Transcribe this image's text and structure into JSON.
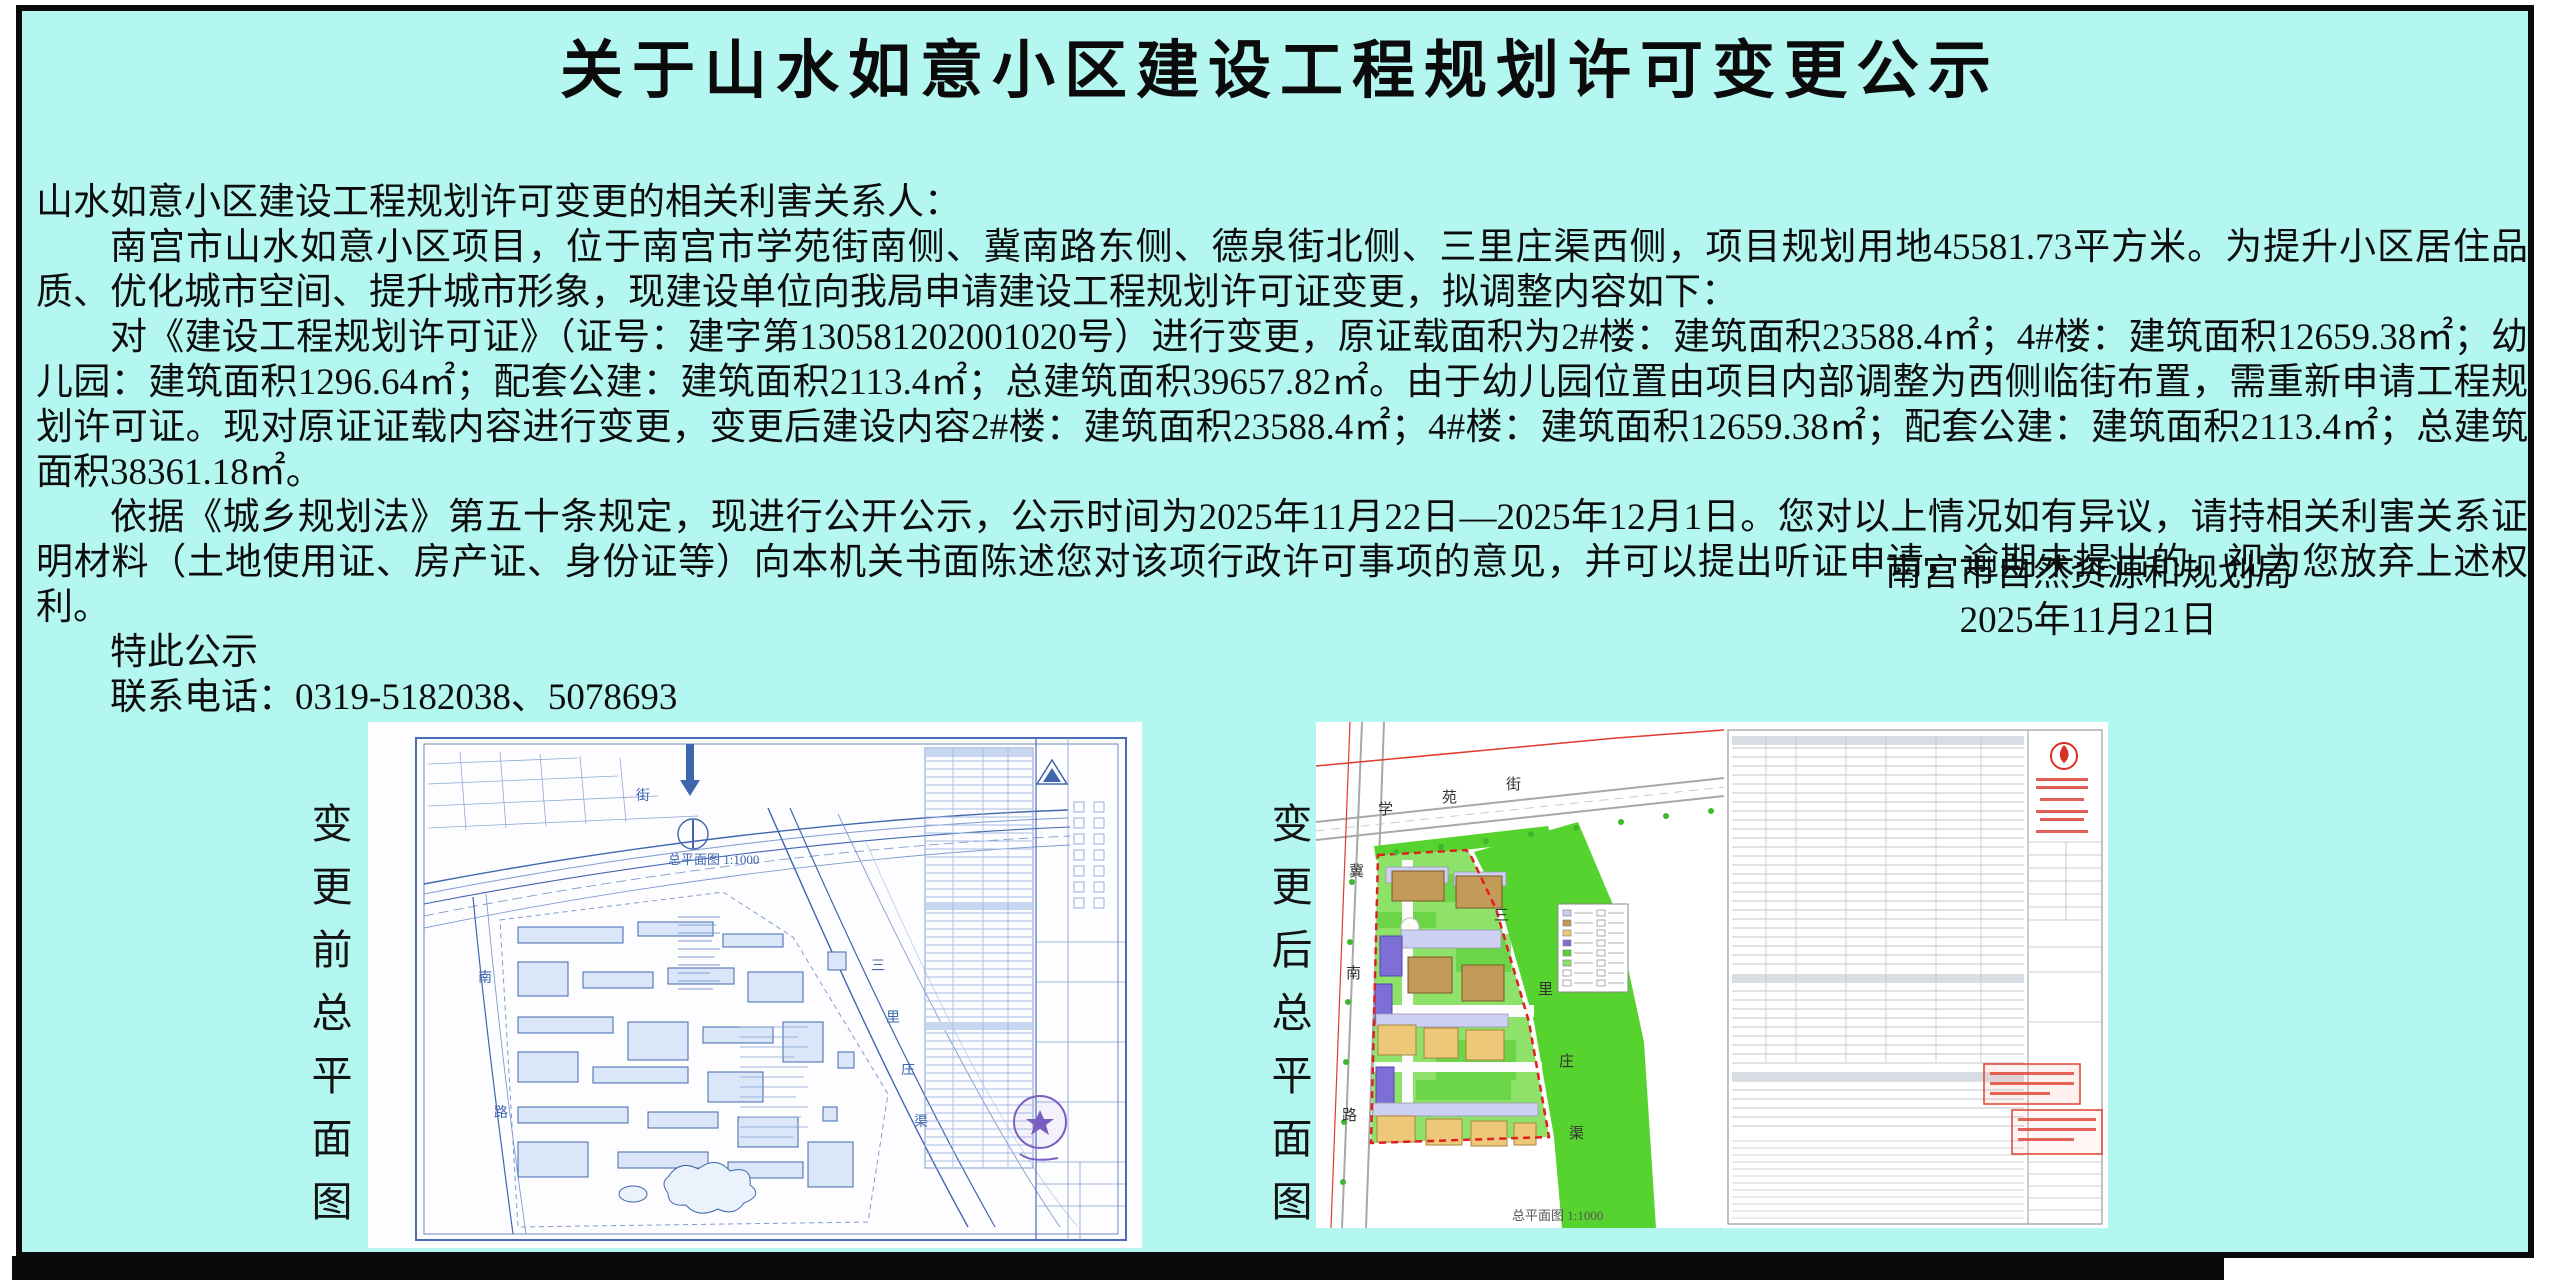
{
  "page": {
    "background_color": "#b4f6f0",
    "frame_color": "#0a0a0a"
  },
  "notice": {
    "title": "关于山水如意小区建设工程规划许可变更公示",
    "salutation": "山水如意小区建设工程规划许可变更的相关利害关系人：",
    "para1": "南宫市山水如意小区项目，位于南宫市学苑街南侧、冀南路东侧、德泉街北侧、三里庄渠西侧，项目规划用地45581.73平方米。为提升小区居住品质、优化城市空间、提升城市形象，现建设单位向我局申请建设工程规划许可证变更，拟调整内容如下：",
    "para2": "对《建设工程规划许可证》（证号：建字第130581202001020号）进行变更，原证载面积为2#楼：建筑面积23588.4㎡；4#楼：建筑面积12659.38㎡；幼儿园：建筑面积1296.64㎡；配套公建：建筑面积2113.4㎡；总建筑面积39657.82㎡。由于幼儿园位置由项目内部调整为西侧临街布置，需重新申请工程规划许可证。现对原证证载内容进行变更，变更后建设内容2#楼：建筑面积23588.4㎡；4#楼：建筑面积12659.38㎡；配套公建：建筑面积2113.4㎡；总建筑面积38361.18㎡。",
    "para3": "依据《城乡规划法》第五十条规定，现进行公开公示，公示时间为2025年11月22日—2025年12月1日。您对以上情况如有异议，请持相关利害关系证明材料（土地使用证、房产证、身份证等）向本机关书面陈述您对该项行政许可事项的意见，并可以提出听证申请，逾期未提出的，视为您放弃上述权利。",
    "closing": "特此公示",
    "contact": "联系电话：0319-5182038、5078693",
    "issuer": "南宫市自然资源和规划局",
    "date": "2025年11月21日"
  },
  "figures": {
    "before": {
      "caption": "变更前总平面图",
      "scale_label": "总平面图 1:1000",
      "road_left": [
        "南",
        "路"
      ],
      "road_right": [
        "三",
        "里",
        "庄",
        "渠"
      ],
      "road_top": "街"
    },
    "after": {
      "caption": "变更后总平面图",
      "scale_label": "总平面图 1:1000",
      "street_top": [
        "学",
        "苑",
        "街"
      ],
      "street_left": [
        "冀",
        "南",
        "路"
      ],
      "street_right": [
        "三",
        "里",
        "庄",
        "渠"
      ]
    }
  }
}
